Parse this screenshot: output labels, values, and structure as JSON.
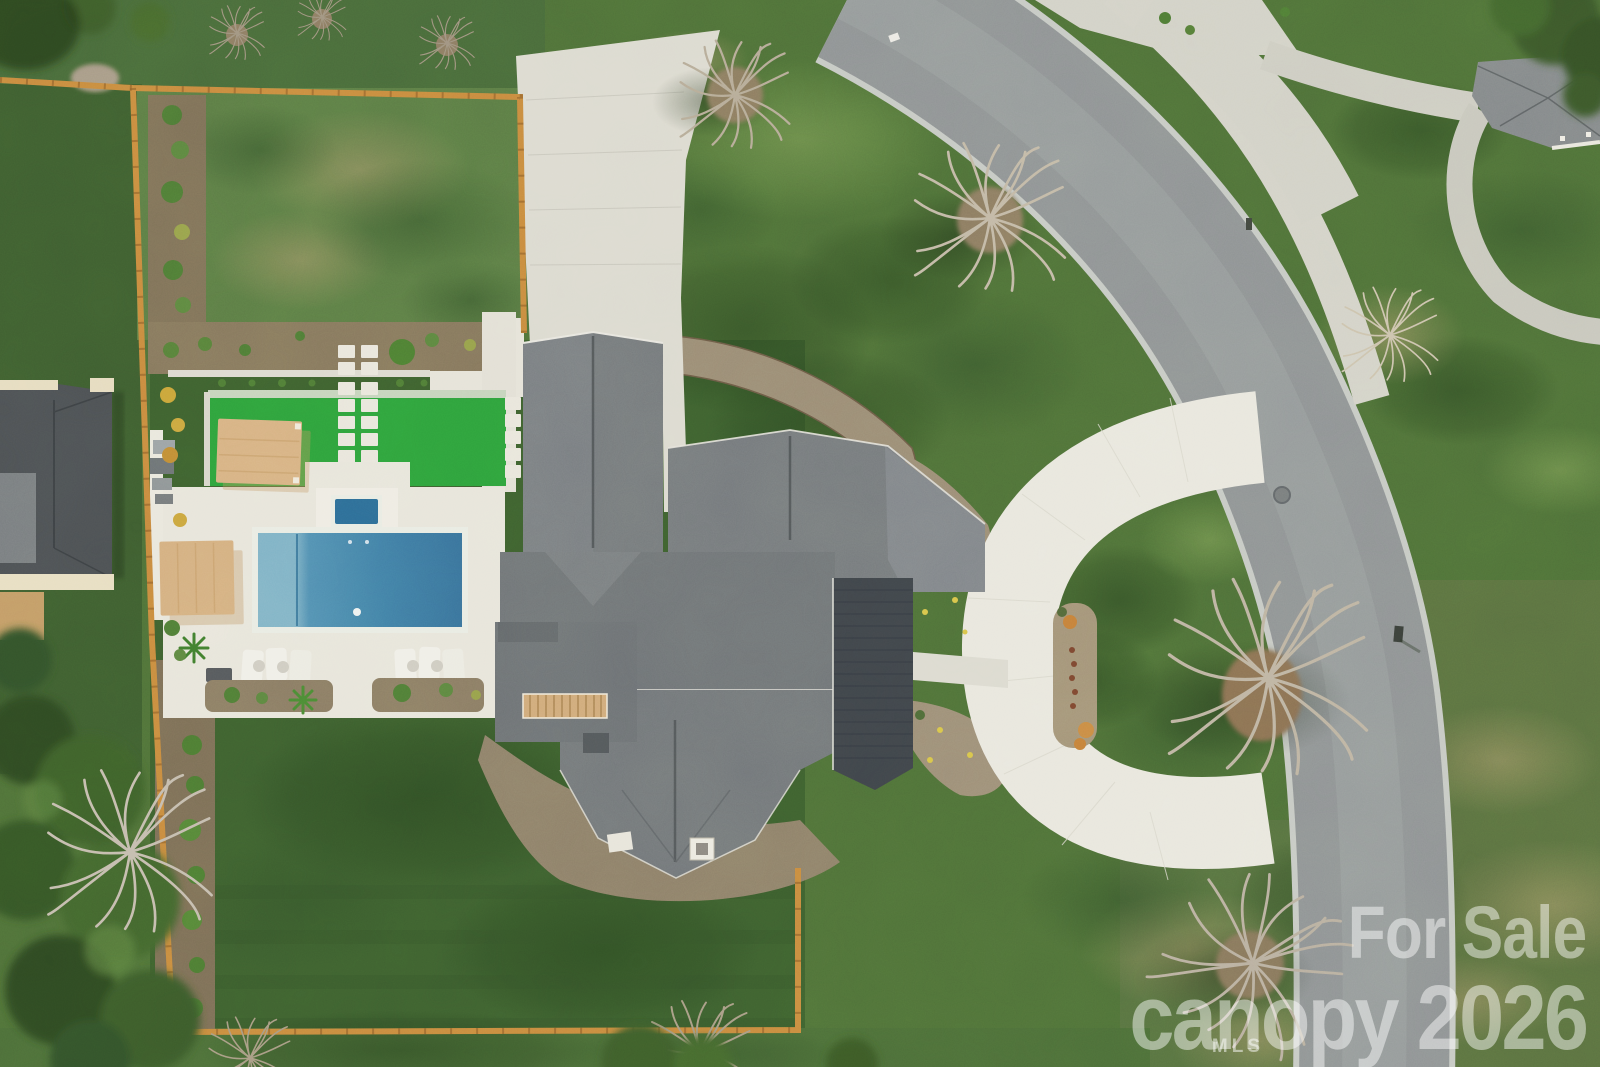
{
  "watermark": {
    "line1": "For Sale",
    "line2_word": "canopy",
    "line2_year": "2026",
    "mls": "MLS"
  },
  "palette": {
    "lawn_base": "#4e6f38",
    "lawn_back": "#3d5f2f",
    "turf_green": "#2ea13c",
    "asphalt": "#8e9294",
    "concrete_drive": "#dcdad0",
    "concrete_ring": "#e9e7de",
    "pool_water": "#4a8ab0",
    "spa_water": "#2d6b96",
    "roof_shingle": "#75797d",
    "roof_metal": "#3f444a",
    "fence_orange": "#c8893f",
    "pergola_tan": "#d7b183",
    "mulch_brown": "#85765d",
    "deck_white": "#e8e5db"
  }
}
